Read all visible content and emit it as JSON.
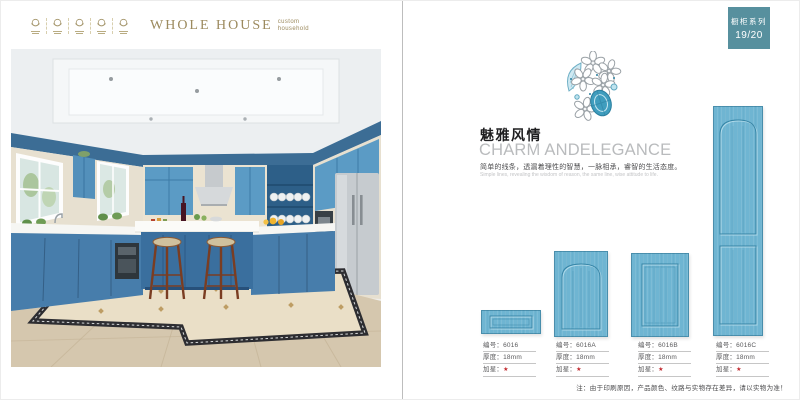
{
  "page_left": {
    "brand": {
      "name": "WHOLE HOUSE",
      "subtitle_line1": "custom",
      "subtitle_line2": "household"
    }
  },
  "page_right": {
    "series_badge": {
      "title": "橱柜系列",
      "page_no": "19/20"
    },
    "headline_cn": "魅雅风情",
    "headline_en": "CHARM ANDELEGANCE",
    "desc_cn": "简单的线条，透漏着理性的智慧，一脉相承，睿智的生活态度。",
    "desc_en": "Simple lines, revealing the wisdom of reason, the same line, wise attitude to life.",
    "spec_labels": {
      "code": "编号：",
      "thickness": "厚度：",
      "star": "加星："
    },
    "products": [
      {
        "code": "6016",
        "thickness": "18mm",
        "star": "★"
      },
      {
        "code": "6016A",
        "thickness": "18mm",
        "star": "★"
      },
      {
        "code": "6016B",
        "thickness": "18mm",
        "star": "★"
      },
      {
        "code": "6016C",
        "thickness": "18mm",
        "star": "★"
      }
    ],
    "note": "注：由于印刷原因，产品颜色、纹路与实物存在差异，请以实物为准！"
  },
  "colors": {
    "brand_gold": "#9c8a5e",
    "badge_teal": "#57909e",
    "door_blue": "#6fb5d2",
    "star_red": "#c1272d"
  }
}
